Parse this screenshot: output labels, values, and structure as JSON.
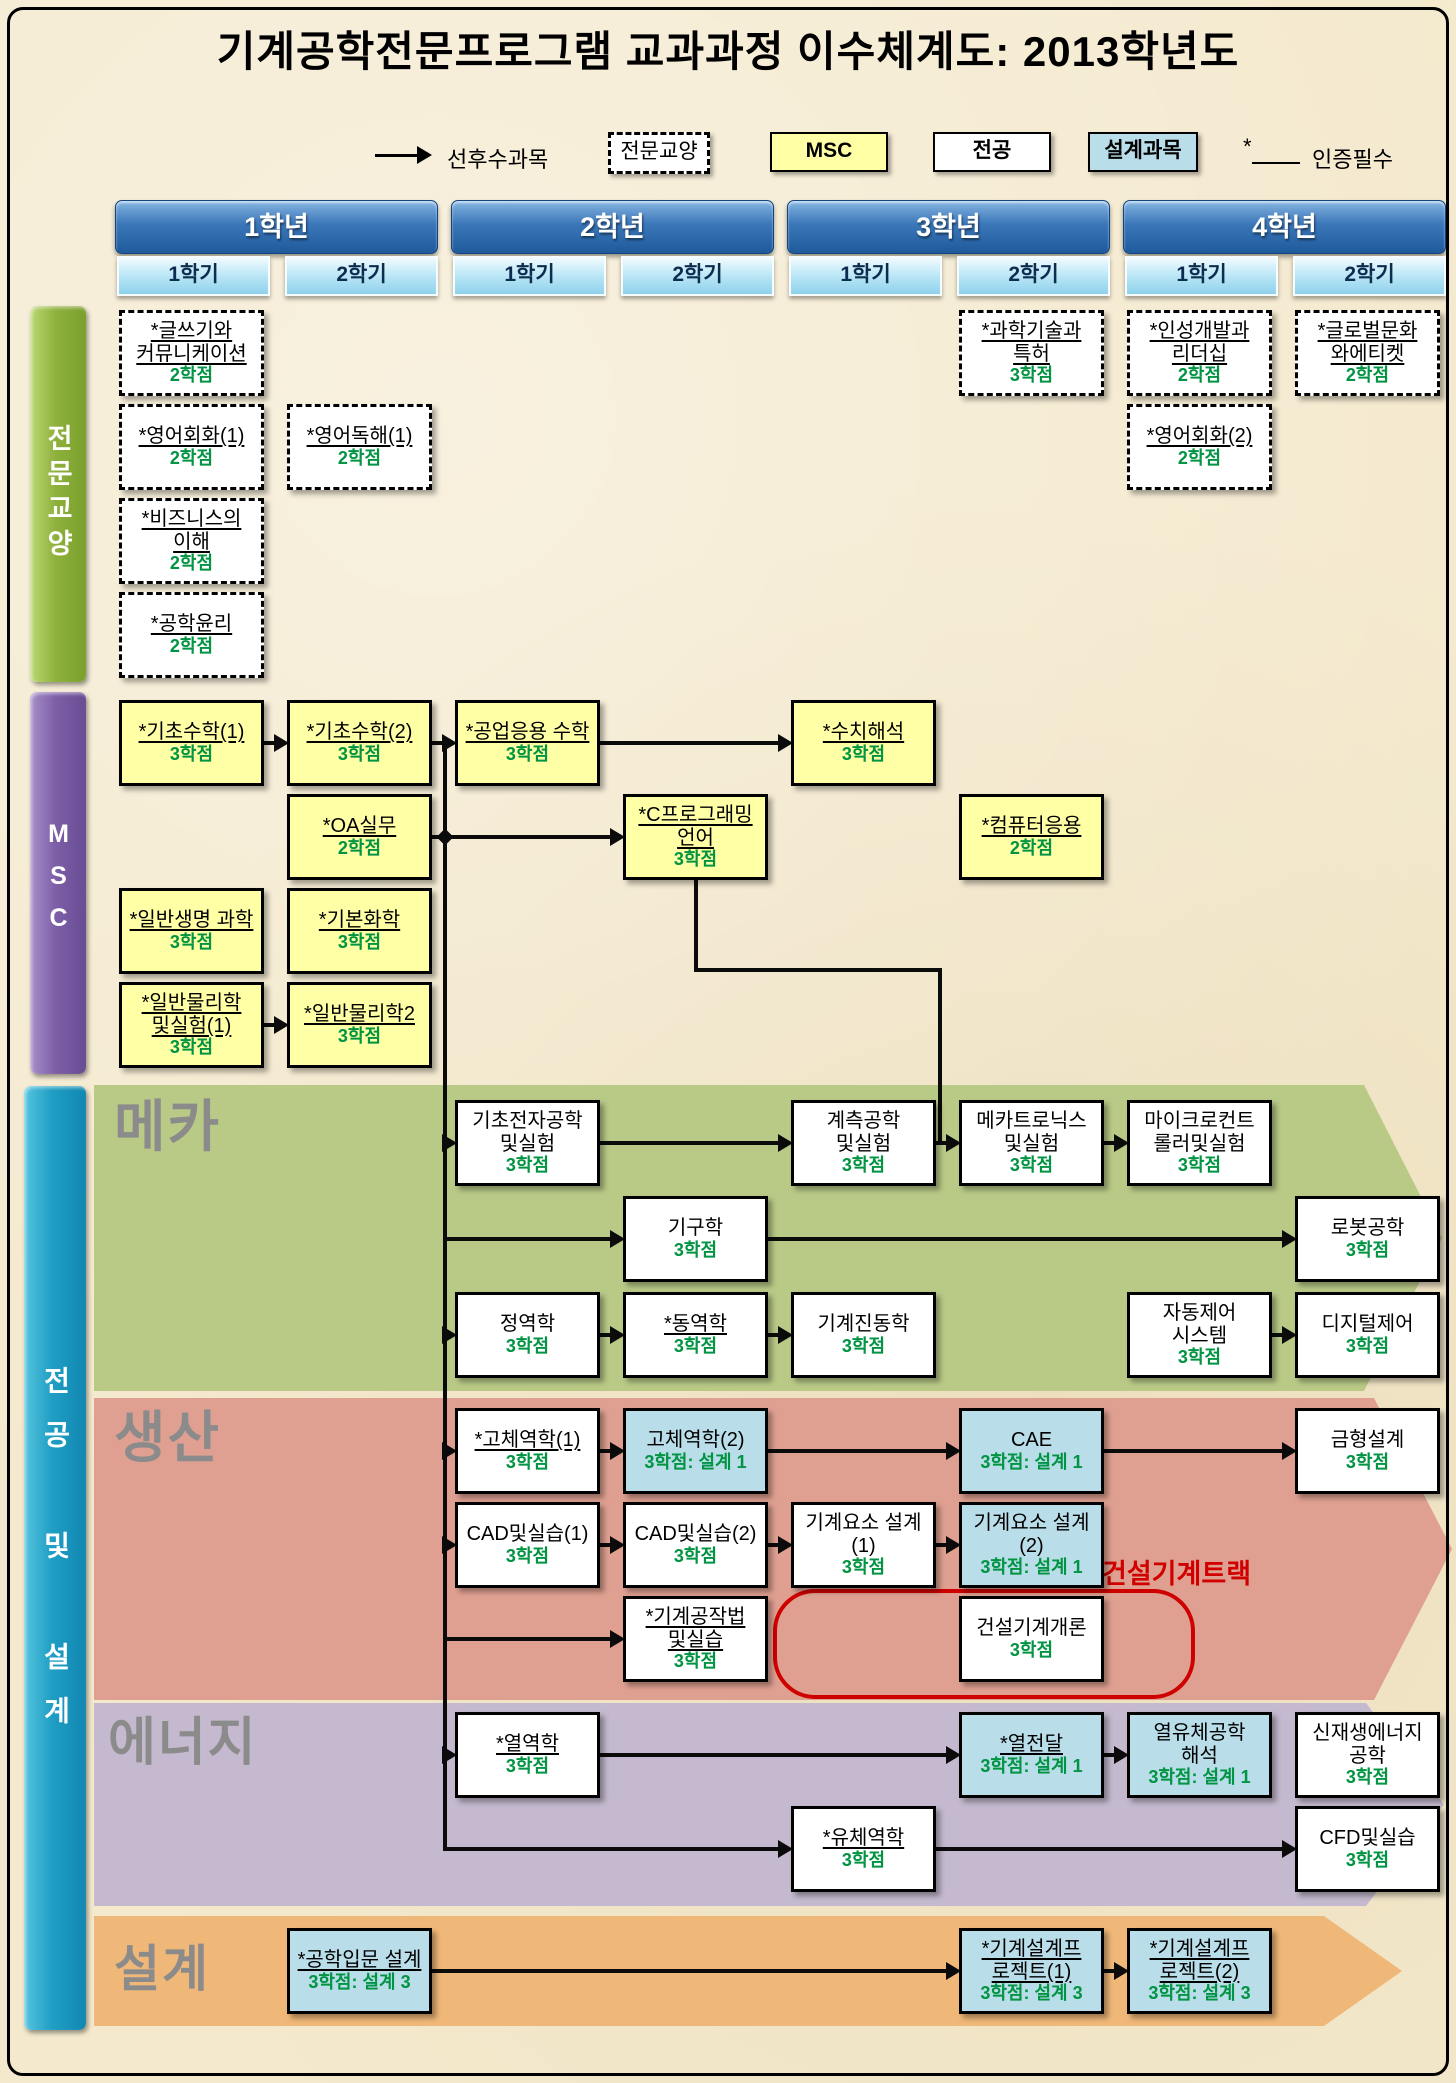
{
  "title": "기계공학전문프로그램 교과과정 이수체계도: 2013학년도",
  "legend": {
    "arrow_label": "선후수과목",
    "ge_label": "전문교양",
    "msc_label": "MSC",
    "major_label": "전공",
    "design_label": "설계과목",
    "required_prefix": "*",
    "required_label": "인증필수"
  },
  "header": {
    "years": [
      {
        "label": "1학년",
        "semesters": [
          "1학기",
          "2학기"
        ]
      },
      {
        "label": "2학년",
        "semesters": [
          "1학기",
          "2학기"
        ]
      },
      {
        "label": "3학년",
        "semesters": [
          "1학기",
          "2학기"
        ]
      },
      {
        "label": "4학년",
        "semesters": [
          "1학기",
          "2학기"
        ]
      }
    ]
  },
  "sidebars": [
    {
      "id": "ge",
      "label": "전문교양"
    },
    {
      "id": "msc",
      "label": "MSC"
    },
    {
      "id": "major",
      "label": "전공 및 설계"
    }
  ],
  "bands": [
    {
      "id": "meka",
      "label": "메카"
    },
    {
      "id": "saengsan",
      "label": "생산"
    },
    {
      "id": "energy",
      "label": "에너지"
    },
    {
      "id": "design",
      "label": "설계"
    }
  ],
  "track_label": "건설기계트랙",
  "colors": {
    "ge_sidebar": "linear-gradient(90deg,#bcd876 0%,#8fb13c 45%,#79a02c 100%)",
    "msc_sidebar": "linear-gradient(90deg,#a98fc9 0%,#7d5fa8 45%,#684c93 100%)",
    "major_sidebar": "linear-gradient(90deg,#57c5df 0%,#1f9ec4 45%,#1187b1 100%)",
    "meka_band": "#b9ca87",
    "saengsan_band": "#dfa091",
    "energy_band": "#c4b9ce",
    "design_band": "#f0b878",
    "msc_box": "#ffffa6",
    "design_box": "#b9dde9",
    "credit_green": "#019442",
    "track_red": "#cf0000"
  },
  "courses": [
    {
      "id": "ge-writing",
      "name": "*글쓰기와 커뮤니케이션",
      "credit": "2학점",
      "type": "ge",
      "starred": true,
      "col": "c11",
      "row": "R1"
    },
    {
      "id": "ge-engconv1",
      "name": "*영어회화(1)",
      "credit": "2학점",
      "type": "ge",
      "starred": true,
      "col": "c11",
      "row": "R2"
    },
    {
      "id": "ge-biz",
      "name": "*비즈니스의 이해",
      "credit": "2학점",
      "type": "ge",
      "starred": true,
      "col": "c11",
      "row": "R3"
    },
    {
      "id": "ge-ethics",
      "name": "*공학윤리",
      "credit": "2학점",
      "type": "ge",
      "starred": true,
      "col": "c11",
      "row": "R4"
    },
    {
      "id": "ge-engread1",
      "name": "*영어독해(1)",
      "credit": "2학점",
      "type": "ge",
      "starred": true,
      "col": "c12",
      "row": "R2"
    },
    {
      "id": "ge-patent",
      "name": "*과학기술과 특허",
      "credit": "3학점",
      "type": "ge",
      "starred": true,
      "col": "c32",
      "row": "R1"
    },
    {
      "id": "ge-leader",
      "name": "*인성개발과 리더십",
      "credit": "2학점",
      "type": "ge",
      "starred": true,
      "col": "c41",
      "row": "R1"
    },
    {
      "id": "ge-global",
      "name": "*글로벌문화 와에티켓",
      "credit": "2학점",
      "type": "ge",
      "starred": true,
      "col": "c42",
      "row": "R1"
    },
    {
      "id": "ge-engconv2",
      "name": "*영어회화(2)",
      "credit": "2학점",
      "type": "ge",
      "starred": true,
      "col": "c41",
      "row": "R2"
    },
    {
      "id": "msc-math1",
      "name": "*기초수학(1)",
      "credit": "3학점",
      "type": "msc",
      "starred": true,
      "col": "c11",
      "row": "M1"
    },
    {
      "id": "msc-math2",
      "name": "*기초수학(2)",
      "credit": "3학점",
      "type": "msc",
      "starred": true,
      "col": "c12",
      "row": "M1"
    },
    {
      "id": "msc-engmath",
      "name": "*공업응용 수학",
      "credit": "3학점",
      "type": "msc",
      "starred": true,
      "col": "c21",
      "row": "M1"
    },
    {
      "id": "msc-numer",
      "name": "*수치해석",
      "credit": "3학점",
      "type": "msc",
      "starred": true,
      "col": "c31",
      "row": "M1"
    },
    {
      "id": "msc-oa",
      "name": "*OA실무",
      "credit": "2학점",
      "type": "msc",
      "starred": true,
      "col": "c12",
      "row": "M2"
    },
    {
      "id": "msc-c",
      "name": "*C프로그래밍 언어",
      "credit": "3학점",
      "type": "msc",
      "starred": true,
      "col": "c22",
      "row": "M2"
    },
    {
      "id": "msc-comp",
      "name": "*컴퓨터응용",
      "credit": "2학점",
      "type": "msc",
      "starred": true,
      "col": "c32",
      "row": "M2"
    },
    {
      "id": "msc-bio",
      "name": "*일반생명 과학",
      "credit": "3학점",
      "type": "msc",
      "starred": true,
      "col": "c11",
      "row": "M3"
    },
    {
      "id": "msc-chem",
      "name": "*기본화학",
      "credit": "3학점",
      "type": "msc",
      "starred": true,
      "col": "c12",
      "row": "M3"
    },
    {
      "id": "msc-phys1",
      "name": "*일반물리학 및실험(1)",
      "credit": "3학점",
      "type": "msc",
      "starred": true,
      "col": "c11",
      "row": "M4"
    },
    {
      "id": "msc-phys2",
      "name": "*일반물리학2",
      "credit": "3학점",
      "type": "msc",
      "starred": true,
      "col": "c12",
      "row": "M4"
    },
    {
      "id": "mk-electronics",
      "name": "기초전자공학 및실험",
      "credit": "3학점",
      "type": "major",
      "starred": false,
      "col": "c21",
      "row": "K1"
    },
    {
      "id": "mk-measure",
      "name": "계측공학 및실험",
      "credit": "3학점",
      "type": "major",
      "starred": false,
      "col": "c31",
      "row": "K1"
    },
    {
      "id": "mk-mechatron",
      "name": "메카트로닉스 및실험",
      "credit": "3학점",
      "type": "major",
      "starred": false,
      "col": "c32",
      "row": "K1"
    },
    {
      "id": "mk-micro",
      "name": "마이크로컨트 롤러및실험",
      "credit": "3학점",
      "type": "major",
      "starred": false,
      "col": "c41",
      "row": "K1"
    },
    {
      "id": "mk-kinematics",
      "name": "기구학",
      "credit": "3학점",
      "type": "major",
      "starred": false,
      "col": "c22",
      "row": "K2"
    },
    {
      "id": "mk-robot",
      "name": "로봇공학",
      "credit": "3학점",
      "type": "major",
      "starred": false,
      "col": "c42",
      "row": "K2"
    },
    {
      "id": "mk-statics",
      "name": "정역학",
      "credit": "3학점",
      "type": "major",
      "starred": false,
      "col": "c21",
      "row": "K3"
    },
    {
      "id": "mk-dynamics",
      "name": "*동역학",
      "credit": "3학점",
      "type": "major",
      "starred": true,
      "col": "c22",
      "row": "K3"
    },
    {
      "id": "mk-vibration",
      "name": "기계진동학",
      "credit": "3학점",
      "type": "major",
      "starred": false,
      "col": "c31",
      "row": "K3"
    },
    {
      "id": "mk-autoctrl",
      "name": "자동제어 시스템",
      "credit": "3학점",
      "type": "major",
      "starred": false,
      "col": "c41",
      "row": "K3"
    },
    {
      "id": "mk-digital",
      "name": "디지털제어",
      "credit": "3학점",
      "type": "major",
      "starred": false,
      "col": "c42",
      "row": "K3"
    },
    {
      "id": "pr-solid1",
      "name": "*고체역학(1)",
      "credit": "3학점",
      "type": "major",
      "starred": true,
      "col": "c21",
      "row": "S1"
    },
    {
      "id": "pr-solid2",
      "name": "고체역학(2)",
      "credit": "3학점: 설계 1",
      "type": "design",
      "starred": false,
      "col": "c22",
      "row": "S1"
    },
    {
      "id": "pr-cae",
      "name": "CAE",
      "credit": "3학점: 설계 1",
      "type": "design",
      "starred": false,
      "col": "c32",
      "row": "S1"
    },
    {
      "id": "pr-mold",
      "name": "금형설계",
      "credit": "3학점",
      "type": "major",
      "starred": false,
      "col": "c42",
      "row": "S1"
    },
    {
      "id": "pr-cad1",
      "name": "CAD및실습(1)",
      "credit": "3학점",
      "type": "major",
      "starred": false,
      "col": "c21",
      "row": "S2"
    },
    {
      "id": "pr-cad2",
      "name": "CAD및실습(2)",
      "credit": "3학점",
      "type": "major",
      "starred": false,
      "col": "c22",
      "row": "S2"
    },
    {
      "id": "pr-elem1",
      "name": "기계요소 설계(1)",
      "credit": "3학점",
      "type": "major",
      "starred": false,
      "col": "c31",
      "row": "S2"
    },
    {
      "id": "pr-elem2",
      "name": "기계요소 설계(2)",
      "credit": "3학점: 설계 1",
      "type": "design",
      "starred": false,
      "col": "c32",
      "row": "S2"
    },
    {
      "id": "pr-machining",
      "name": "*기계공작법 및실습",
      "credit": "3학점",
      "type": "major",
      "starred": true,
      "col": "c22",
      "row": "S3"
    },
    {
      "id": "pr-constr",
      "name": "건설기계개론",
      "credit": "3학점",
      "type": "major",
      "starred": false,
      "col": "c32",
      "row": "S3"
    },
    {
      "id": "en-thermo",
      "name": "*열역학",
      "credit": "3학점",
      "type": "major",
      "starred": true,
      "col": "c21",
      "row": "E1"
    },
    {
      "id": "en-heat",
      "name": "*열전달",
      "credit": "3학점: 설계 1",
      "type": "design",
      "starred": true,
      "col": "c32",
      "row": "E1"
    },
    {
      "id": "en-thermofluid",
      "name": "열유체공학 해석",
      "credit": "3학점: 설계 1",
      "type": "design",
      "starred": false,
      "col": "c41",
      "row": "E1"
    },
    {
      "id": "en-renewable",
      "name": "신재생에너지 공학",
      "credit": "3학점",
      "type": "major",
      "starred": false,
      "col": "c42",
      "row": "E1"
    },
    {
      "id": "en-fluid",
      "name": "*유체역학",
      "credit": "3학점",
      "type": "major",
      "starred": true,
      "col": "c31",
      "row": "E2"
    },
    {
      "id": "en-cfd",
      "name": "CFD및실습",
      "credit": "3학점",
      "type": "major",
      "starred": false,
      "col": "c42",
      "row": "E2"
    },
    {
      "id": "ds-intro",
      "name": "*공학입문 설계",
      "credit": "3학점: 설계 3",
      "type": "design",
      "starred": true,
      "col": "c12",
      "row": "D1"
    },
    {
      "id": "ds-proj1",
      "name": "*기계설계프 로젝트(1)",
      "credit": "3학점: 설계 3",
      "type": "design",
      "starred": true,
      "col": "c32",
      "row": "D1"
    },
    {
      "id": "ds-proj2",
      "name": "*기계설계프 로젝트(2)",
      "credit": "3학점: 설계 3",
      "type": "design",
      "starred": true,
      "col": "c41",
      "row": "D1"
    }
  ],
  "edges": [
    {
      "from": "msc-math1",
      "to": "msc-math2"
    },
    {
      "from": "msc-math2",
      "to": "msc-engmath"
    },
    {
      "from": "msc-engmath",
      "to": "msc-numer"
    },
    {
      "from": "msc-oa",
      "to": "msc-c"
    },
    {
      "from": "msc-phys1",
      "to": "msc-phys2"
    },
    {
      "from": "msc-c",
      "to": "mk-mechatron",
      "route": "elbow"
    },
    {
      "from": "trunk",
      "to": "mk-electronics",
      "route": "trunk"
    },
    {
      "from": "trunk",
      "to": "mk-kinematics",
      "route": "trunk"
    },
    {
      "from": "trunk",
      "to": "mk-statics",
      "route": "trunk"
    },
    {
      "from": "trunk",
      "to": "pr-solid1",
      "route": "trunk"
    },
    {
      "from": "trunk",
      "to": "pr-cad1",
      "route": "trunk"
    },
    {
      "from": "trunk",
      "to": "pr-machining",
      "route": "trunk"
    },
    {
      "from": "trunk",
      "to": "en-thermo",
      "route": "trunk"
    },
    {
      "from": "trunk",
      "to": "en-fluid",
      "route": "trunk"
    },
    {
      "from": "mk-electronics",
      "to": "mk-measure"
    },
    {
      "from": "mk-measure",
      "to": "mk-mechatron"
    },
    {
      "from": "mk-mechatron",
      "to": "mk-micro"
    },
    {
      "from": "mk-kinematics",
      "to": "mk-robot"
    },
    {
      "from": "mk-statics",
      "to": "mk-dynamics"
    },
    {
      "from": "mk-dynamics",
      "to": "mk-vibration"
    },
    {
      "from": "mk-autoctrl",
      "to": "mk-digital"
    },
    {
      "from": "pr-solid1",
      "to": "pr-solid2"
    },
    {
      "from": "pr-solid2",
      "to": "pr-cae"
    },
    {
      "from": "pr-cae",
      "to": "pr-mold"
    },
    {
      "from": "pr-cad1",
      "to": "pr-cad2"
    },
    {
      "from": "pr-cad2",
      "to": "pr-elem1"
    },
    {
      "from": "pr-elem1",
      "to": "pr-elem2"
    },
    {
      "from": "en-thermo",
      "to": "en-heat"
    },
    {
      "from": "en-heat",
      "to": "en-thermofluid"
    },
    {
      "from": "en-fluid",
      "to": "en-cfd"
    },
    {
      "from": "ds-intro",
      "to": "ds-proj1"
    },
    {
      "from": "ds-proj1",
      "to": "ds-proj2"
    }
  ]
}
